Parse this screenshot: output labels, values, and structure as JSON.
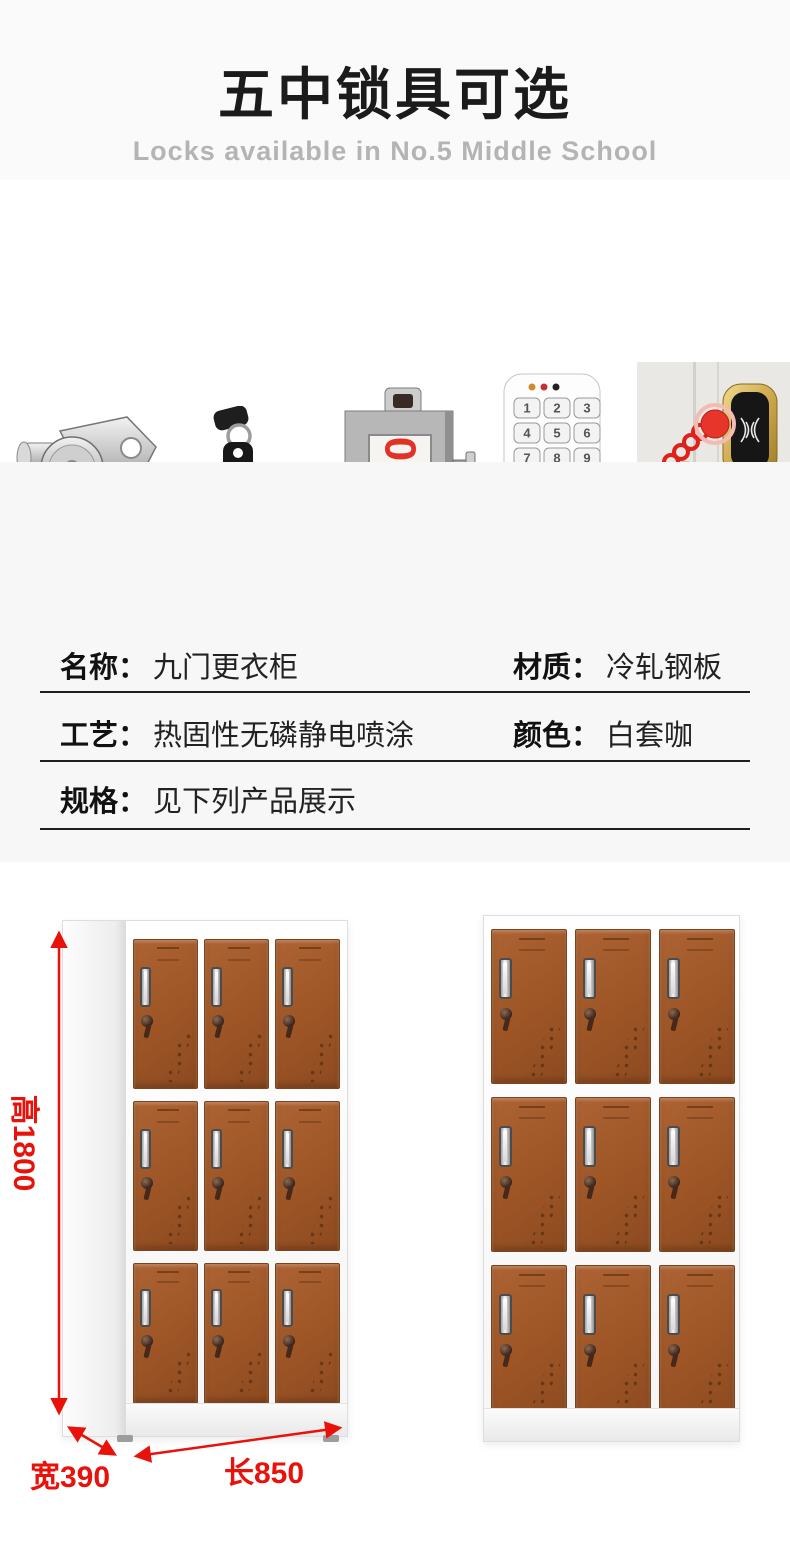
{
  "colors": {
    "accent_red": "#e8120b",
    "label_brown": "#875a41",
    "door_brown": "#9d5526",
    "keypad_red": "#cc2a27",
    "keypad_green": "#55b845",
    "lock_gold": "#c9a84c"
  },
  "header": {
    "title": "五中锁具可选",
    "subtitle": "Locks available in No.5 Middle School"
  },
  "locks": {
    "labels": [
      "门挂锁",
      "钥匙锁",
      "插卡锁",
      "密码锁",
      "感应锁"
    ],
    "card_number": "008",
    "keypad_keys": [
      "1",
      "2",
      "3",
      "4",
      "5",
      "6",
      "7",
      "8",
      "9",
      "C",
      "0",
      "↵"
    ]
  },
  "product_info": {
    "title": "产品信息",
    "fields": [
      {
        "label": "名称：",
        "value": "九门更衣柜"
      },
      {
        "label": "材质：",
        "value": "冷轧钢板"
      },
      {
        "label": "工艺：",
        "value": "热固性无磷静电喷涂"
      },
      {
        "label": "颜色：",
        "value": "白套咖"
      },
      {
        "label": "规格：",
        "value": "见下列产品展示"
      }
    ]
  },
  "showcase": {
    "height_label": "高1800",
    "width_label": "宽390",
    "length_label": "长850"
  }
}
